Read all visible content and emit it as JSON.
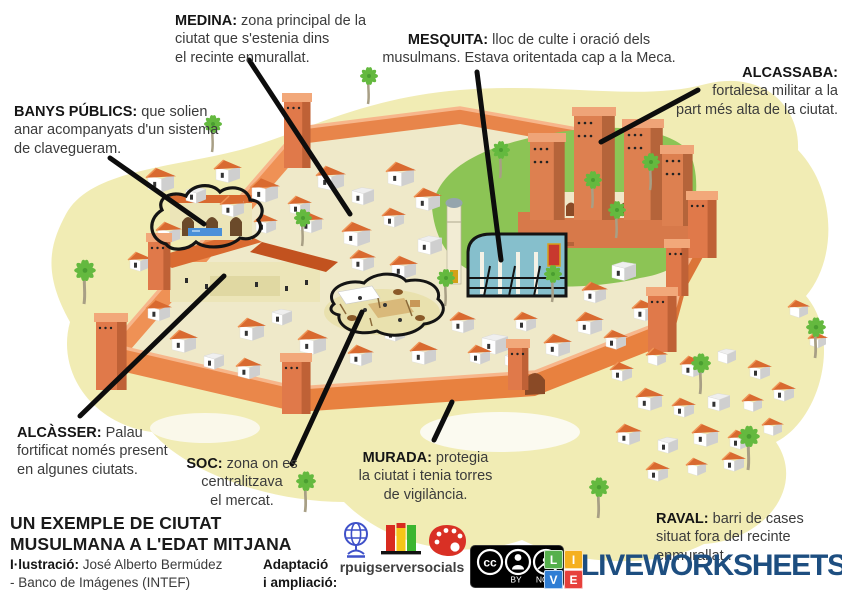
{
  "labels": {
    "medina": {
      "term": "MEDINA:",
      "desc": " zona principal de la\nciutat que s'estenia dins\nel recinte enmurallat."
    },
    "mesquita": {
      "term": "MESQUITA:",
      "desc": " lloc de culte i oració dels\nmusulmans. Estava oritentada cap a la Meca."
    },
    "alcassaba": {
      "term": "ALCASSABA:",
      "desc": "\nfortalesa militar a la\npart més alta de la ciutat."
    },
    "banys": {
      "term": "BANYS PÚBLICS:",
      "desc": " que solien\nanar acompanyats d'un sistema\nde clavegueram."
    },
    "alcasser": {
      "term": "ALCÀSSER:",
      "desc": "  Palau\nfortificat només present\nen algunes ciutats."
    },
    "soc": {
      "term": "SOC:",
      "desc": " zona on es\ncentralitzava\nel mercat."
    },
    "murada": {
      "term": "MURADA:",
      "desc": " protegia\nla ciutat i tenia torres\nde vigilància."
    },
    "raval": {
      "term": "RAVAL:",
      "desc": " barri de cases\nsituat fora del recinte\nenmurallat ."
    }
  },
  "footer": {
    "title_line1": "UN EXEMPLE DE CIUTAT",
    "title_line2": "MUSULMANA A L'EDAT MITJANA",
    "illustration_label": "I·lustració:",
    "illustration_credit": " José Alberto Bermúdez",
    "illustration_credit2": "- Banco de Imágenes (INTEF)",
    "adaptation_label": "Adaptació\ni ampliació:",
    "adaptation_author": "rpuigserversocials",
    "cc_by": "BY",
    "cc_nc": "NC",
    "brand": "LIVEWORKSHEETS",
    "brand_color": "#1d4e80",
    "live_tiles": [
      {
        "letter": "L",
        "color": "#56b04c"
      },
      {
        "letter": "I",
        "color": "#f5b01f"
      },
      {
        "letter": "V",
        "color": "#2f7dd4"
      },
      {
        "letter": "E",
        "color": "#e7403b"
      }
    ]
  },
  "illustration": {
    "alt": "Isometric illustration of a walled Muslim medieval city",
    "colors": {
      "sand": "#f1ecb4",
      "ground": "#efe9c9",
      "grass": "#8cc455",
      "wall_light": "#ef9155",
      "wall_mid": "#e8854a",
      "wall_dark": "#d56f36",
      "wall_front": "#e8813f",
      "wall_sw": "#ea874a",
      "wall_e": "#db7438",
      "ridge_hi": "#f7b68b",
      "gate": "#8a4a26",
      "tower": "#e0794a",
      "tower_side": "#bf6136",
      "tower_cap": "#f2a87a",
      "fort": "#dd8050",
      "fort_side": "#b5643a",
      "fort_cap": "#efa478",
      "roof": "#d96a30",
      "roof_hi": "#ef9355",
      "house": "#ffffff",
      "house_side": "#cfcfcf",
      "cream": "#ece5b8",
      "palm": "#64b93f",
      "palm_dark": "#4a9e30",
      "trunk": "#a89f85",
      "water": "#4a90d9",
      "mosque_wall": "#86bfcc",
      "line": "#141414"
    }
  }
}
